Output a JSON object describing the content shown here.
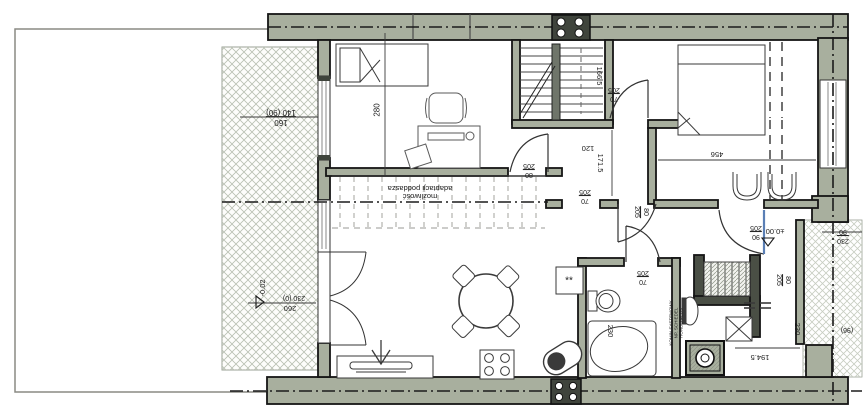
{
  "drawing": {
    "type": "architectural-floor-plan",
    "language": "Polish",
    "level_markers": {
      "interior": "±0.00",
      "terrace": "-0.02"
    },
    "notes": {
      "attic": [
        "możliwość",
        "adaptacji poddasza"
      ],
      "chimney": [
        "KOMIN SYSTEMOWY",
        "NP. SCHIEDEL",
        "RONDO PLUS"
      ]
    },
    "colors": {
      "wall_fill": "#a8af9e",
      "dark_block": "#3f443c",
      "line": "#1b1b1b",
      "terrace_hatch": "#b9c0b2",
      "porch_hatch": "#c7cdc1",
      "door_leaf_accent": "#5a7fb5"
    }
  },
  "labels": [
    {
      "id": "dim-window-study",
      "type": "frac",
      "top": "160",
      "bottom": "140 (90)",
      "x": 281,
      "y": 117,
      "rot": 180,
      "fs": 8
    },
    {
      "id": "dim-study-width",
      "type": "text",
      "text": "280",
      "x": 378,
      "y": 110,
      "rot": -90,
      "fs": 8
    },
    {
      "id": "note-attic",
      "type": "lines",
      "lines": [
        "możliwość",
        "adaptacji poddasza"
      ],
      "x": 420,
      "y": 192,
      "rot": 180,
      "fs": 7.5
    },
    {
      "id": "dim-stair-166-5",
      "type": "text",
      "text": "166.5",
      "x": 599,
      "y": 76,
      "rot": 90,
      "fs": 7.5
    },
    {
      "id": "door-70-205-landing",
      "type": "frac",
      "top": "70",
      "bottom": "205",
      "x": 614,
      "y": 94,
      "rot": 180,
      "fs": 7
    },
    {
      "id": "dim-hall-120",
      "type": "text",
      "text": "120",
      "x": 588,
      "y": 148,
      "rot": 180,
      "fs": 7.5
    },
    {
      "id": "dim-hall-171-5",
      "type": "text",
      "text": "171.5",
      "x": 600,
      "y": 163,
      "rot": 90,
      "fs": 7.5
    },
    {
      "id": "door-80-205-study",
      "type": "frac",
      "top": "80",
      "bottom": "205",
      "x": 529,
      "y": 170,
      "rot": 180,
      "fs": 7
    },
    {
      "id": "door-70-205-hall",
      "type": "frac",
      "top": "70",
      "bottom": "205",
      "x": 585,
      "y": 196,
      "rot": 180,
      "fs": 7
    },
    {
      "id": "dim-bedroom-456",
      "type": "text",
      "text": "456",
      "x": 717,
      "y": 154,
      "rot": 180,
      "fs": 7.5
    },
    {
      "id": "door-80-205-bedroom",
      "type": "frac",
      "top": "80",
      "bottom": "205",
      "x": 641,
      "y": 212,
      "rot": 90,
      "fs": 7
    },
    {
      "id": "door-90-205-entry",
      "type": "frac",
      "top": "90",
      "bottom": "205",
      "x": 756,
      "y": 232,
      "rot": 180,
      "fs": 7
    },
    {
      "id": "level-interior",
      "type": "text",
      "text": "±0.00",
      "x": 775,
      "y": 231,
      "rot": 180,
      "fs": 7.5
    },
    {
      "id": "dim-entry-230-90",
      "type": "frac",
      "top": "230",
      "bottom": "90",
      "x": 843,
      "y": 236,
      "rot": 180,
      "fs": 7
    },
    {
      "id": "door-80-205-stairs",
      "type": "frac",
      "top": "80",
      "bottom": "205",
      "x": 783,
      "y": 280,
      "rot": 90,
      "fs": 7
    },
    {
      "id": "door-70-205-bath",
      "type": "frac",
      "top": "70",
      "bottom": "205",
      "x": 643,
      "y": 277,
      "rot": 180,
      "fs": 7
    },
    {
      "id": "dim-bath-230",
      "type": "text",
      "text": "230",
      "x": 610,
      "y": 331,
      "rot": 90,
      "fs": 7.5
    },
    {
      "id": "note-chimney",
      "type": "lines",
      "lines": [
        "KOMIN SYSTEMOWY",
        "NP. SCHIEDEL",
        "RONDO PLUS"
      ],
      "x": 677,
      "y": 323,
      "rot": -90,
      "fs": 4.5
    },
    {
      "id": "dim-porch-230",
      "type": "text",
      "text": "230",
      "x": 797,
      "y": 329,
      "rot": 90,
      "fs": 7.5
    },
    {
      "id": "dim-194-5",
      "type": "text",
      "text": "194.5",
      "x": 760,
      "y": 357,
      "rot": 180,
      "fs": 7.5
    },
    {
      "id": "level-terrace",
      "type": "text",
      "text": "-0.02",
      "x": 263,
      "y": 288,
      "rot": -90,
      "fs": 7.5
    },
    {
      "id": "dim-terrace-230-0",
      "type": "text",
      "text": "230 (0)",
      "x": 294,
      "y": 297,
      "rot": 180,
      "fs": 7
    },
    {
      "id": "dim-terrace-260",
      "type": "text",
      "text": "260",
      "x": 290,
      "y": 308,
      "rot": 180,
      "fs": 7.5
    },
    {
      "id": "dim-96",
      "type": "text",
      "text": "(96)",
      "x": 847,
      "y": 329,
      "rot": 180,
      "fs": 7
    },
    {
      "id": "fridge-mark",
      "type": "text",
      "text": "**",
      "x": 569,
      "y": 282,
      "rot": 0,
      "fs": 10
    }
  ]
}
